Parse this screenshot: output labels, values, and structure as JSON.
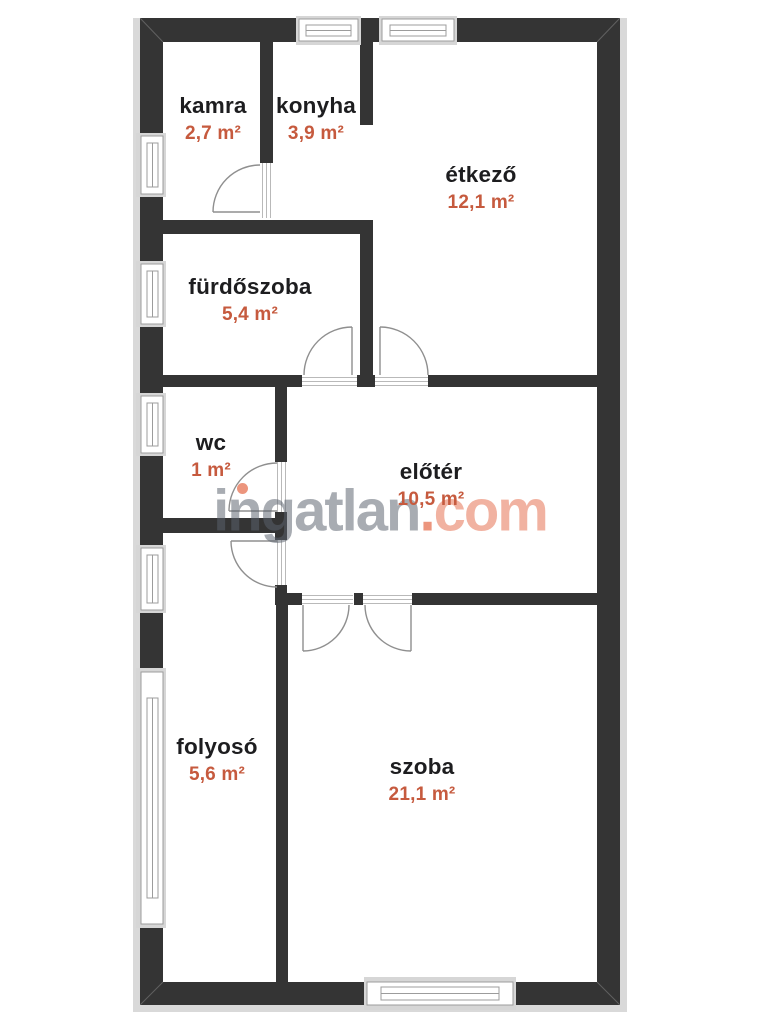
{
  "watermark": {
    "word": "ingatlan",
    "dot": ".",
    "tld": "com"
  },
  "rooms": [
    {
      "name": "kamra",
      "area": "2,7 m²"
    },
    {
      "name": "konyha",
      "area": "3,9 m²"
    },
    {
      "name": "étkező",
      "area": "12,1 m²"
    },
    {
      "name": "fürdőszoba",
      "area": "5,4 m²"
    },
    {
      "name": "wc",
      "area": "1 m²"
    },
    {
      "name": "előtér",
      "area": "10,5 m²"
    },
    {
      "name": "folyosó",
      "area": "5,6 m²"
    },
    {
      "name": "szoba",
      "area": "21,1 m²"
    }
  ],
  "colors": {
    "wall": "#343434",
    "accent": "#c65a3e",
    "label": "#1d1d1f",
    "watermark_gray": "rgba(90,99,110,0.53)",
    "watermark_orange": "rgba(226,94,58,0.48)",
    "watermark_dot": "rgba(226,94,58,0.66)"
  }
}
